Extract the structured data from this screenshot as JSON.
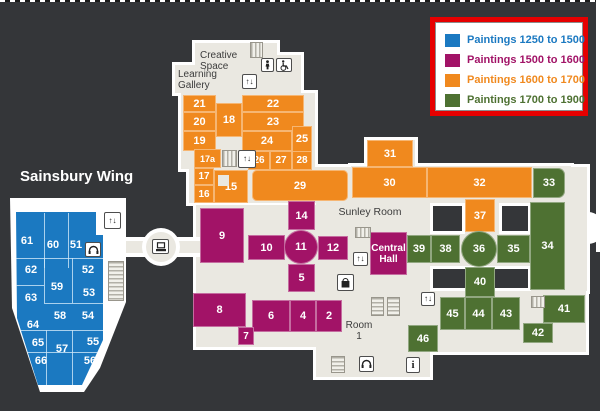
{
  "legend": {
    "items": [
      {
        "label": "Paintings 1250 to 1500",
        "color": "#1b79c1"
      },
      {
        "label": "Paintings 1500 to 1600",
        "color": "#a21367"
      },
      {
        "label": "Paintings 1600 to 1700",
        "color": "#f0891e"
      },
      {
        "label": "Paintings 1700 to 1900",
        "color": "#4e7132"
      }
    ],
    "border_color": "#e60000"
  },
  "areas": {
    "sainsbury_title": "Sainsbury Wing",
    "creative_space_line1": "Creative",
    "creative_space_line2": "Space",
    "learning_gallery_line1": "Learning",
    "learning_gallery_line2": "Gallery",
    "sunley_room": "Sunley Room",
    "central_hall_line1": "Central",
    "central_hall_line2": "Hall",
    "room1_line1": "Room",
    "room1_line2": "1"
  },
  "rooms": {
    "r2": "2",
    "r4": "4",
    "r5": "5",
    "r6": "6",
    "r7": "7",
    "r8": "8",
    "r9": "9",
    "r10": "10",
    "r11": "11",
    "r12": "12",
    "r14": "14",
    "r15": "15",
    "r16": "16",
    "r17": "17",
    "r17a": "17a",
    "r18": "18",
    "r19": "19",
    "r20": "20",
    "r21": "21",
    "r22": "22",
    "r23": "23",
    "r24": "24",
    "r25": "25",
    "r26": "26",
    "r27": "27",
    "r28": "28",
    "r29": "29",
    "r30": "30",
    "r31": "31",
    "r32": "32",
    "r33": "33",
    "r34": "34",
    "r35": "35",
    "r36": "36",
    "r37": "37",
    "r38": "38",
    "r39": "39",
    "r40": "40",
    "r41": "41",
    "r42": "42",
    "r43": "43",
    "r44": "44",
    "r45": "45",
    "r46": "46",
    "r51": "51",
    "r52": "52",
    "r53": "53",
    "r54": "54",
    "r55": "55",
    "r56": "56",
    "r57": "57",
    "r58": "58",
    "r59": "59",
    "r60": "60",
    "r61": "61",
    "r62": "62",
    "r63": "63",
    "r64": "64",
    "r65": "65",
    "r66": "66"
  },
  "glyphs": {
    "elevator": "↑↓",
    "info": "i"
  },
  "colors": {
    "background": "#343639",
    "floor": "#eae8e1",
    "blue": "#1b79c1",
    "magenta": "#a21367",
    "orange": "#f0891e",
    "green": "#4e7132"
  }
}
